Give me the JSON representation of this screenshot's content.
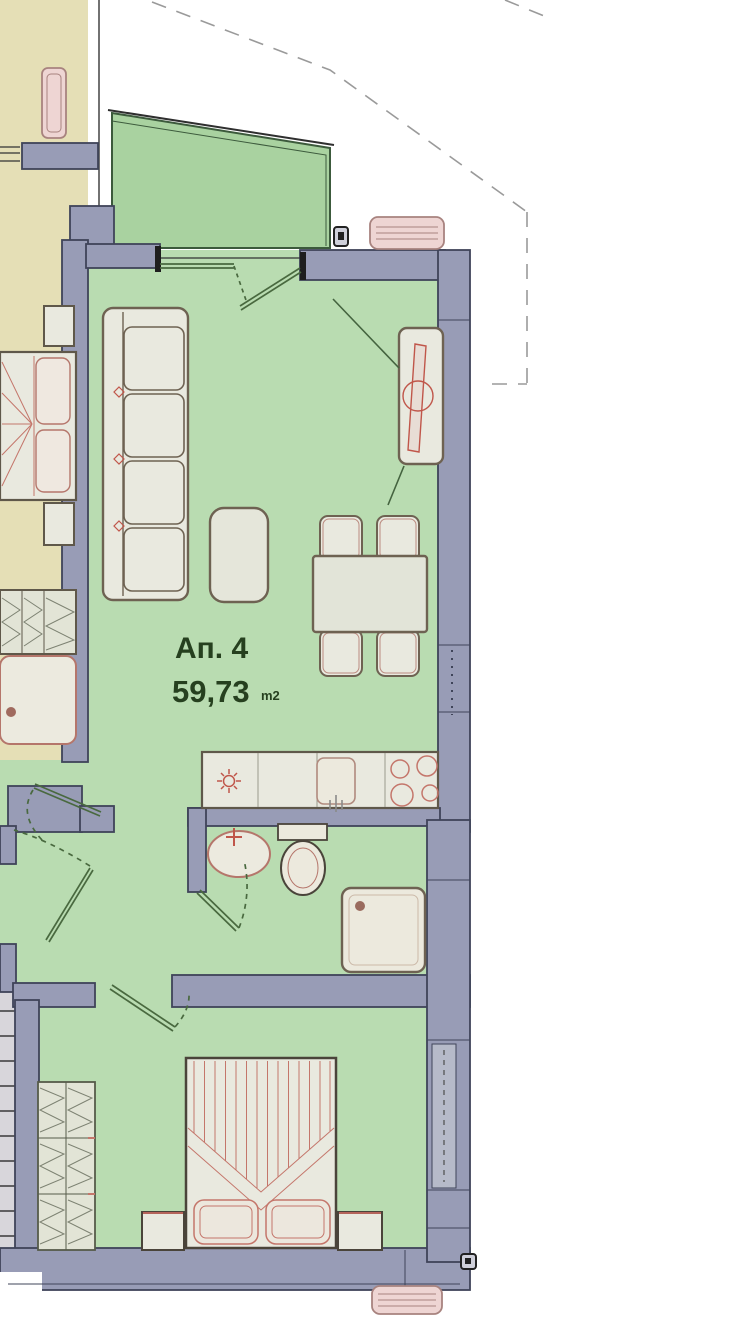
{
  "plan": {
    "apartment": {
      "label": "Ап. 4",
      "area": "59,73",
      "area_unit": "m2"
    },
    "colors": {
      "wall_fill": "#989cb6",
      "wall_stroke": "#3f4459",
      "floor_green": "#b9dcb1",
      "balcony_green": "#a9d2a0",
      "adjacent_floor_beige": "#e5dfb6",
      "furniture_fill": "#e9e9df",
      "furniture_outline": "#6e6252",
      "accent_red": "#c0564a",
      "fixture_pink_fill": "#eed5d3",
      "fixture_pink_stroke": "#a8837f",
      "stair_fill": "#d8d6db",
      "door_green": "#49693f",
      "roofline_gray": "#9a9a9a",
      "label_green": "#26401f"
    }
  }
}
